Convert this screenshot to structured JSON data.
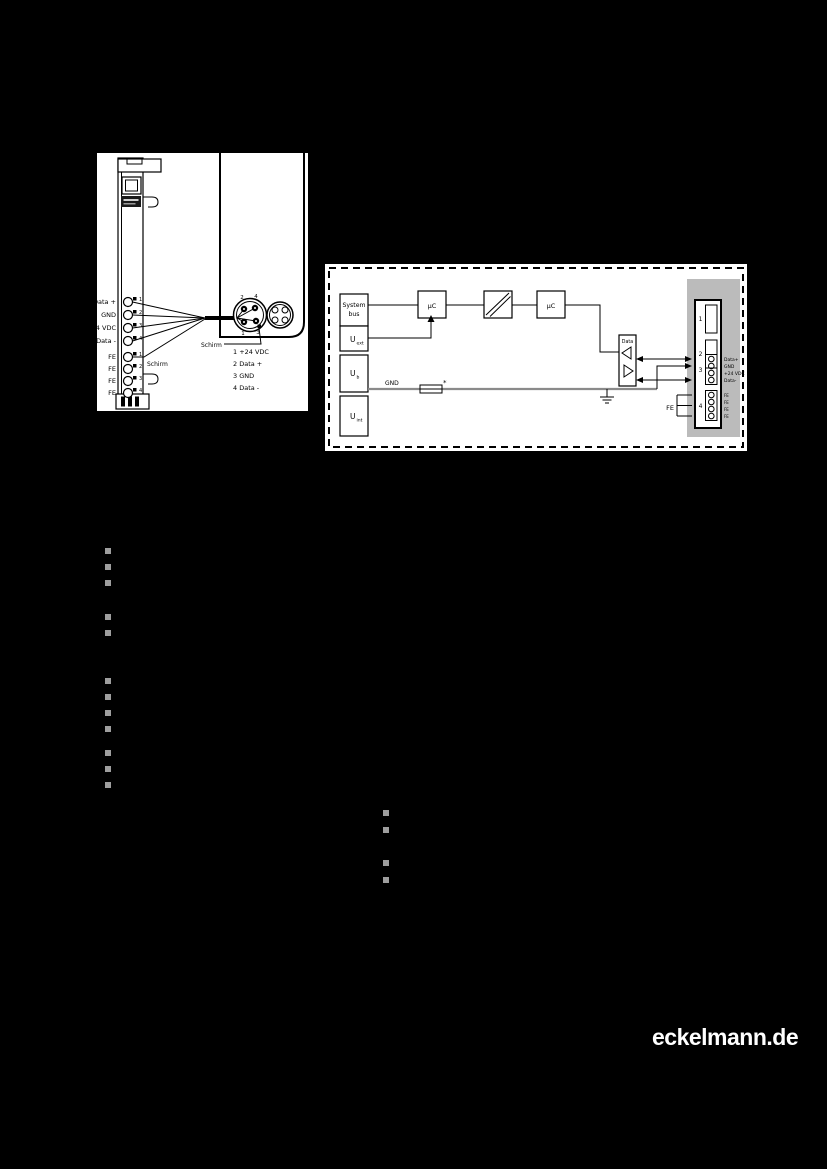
{
  "brand": {
    "website": "eckelmann.de"
  },
  "wiring_diagram": {
    "labels": [
      "Data +",
      "GND",
      "24 VDC",
      "Data -"
    ],
    "numbers": [
      "1",
      "2",
      "3",
      "4"
    ],
    "fe": [
      "FE",
      "FE",
      "FE",
      "FE"
    ],
    "shield_label": "Schirm",
    "pins": [
      "2",
      "4",
      "1",
      "3"
    ],
    "legend": [
      "1  +24 VDC",
      "2  Data +",
      "3  GND",
      "4  Data -"
    ]
  },
  "block_diagram": {
    "system_bus_line1": "System",
    "system_bus_line2": "bus",
    "u_main": "U",
    "u_subs": [
      "ext",
      "b",
      "int"
    ],
    "uc": "µC",
    "data_label": "Data",
    "gnd_label": "GND",
    "fuse_mark": "*",
    "fe_label": "FE",
    "slots": [
      "1",
      "2",
      "3",
      "4"
    ],
    "pin_labels": [
      "Data+",
      "GND",
      "+24 VDC",
      "Data-"
    ],
    "fe_pins": [
      "FE",
      "FE",
      "FE",
      "FE"
    ]
  },
  "bullets": {
    "left_groups": [
      3,
      2,
      4,
      3
    ],
    "right_groups": [
      2,
      2
    ]
  }
}
